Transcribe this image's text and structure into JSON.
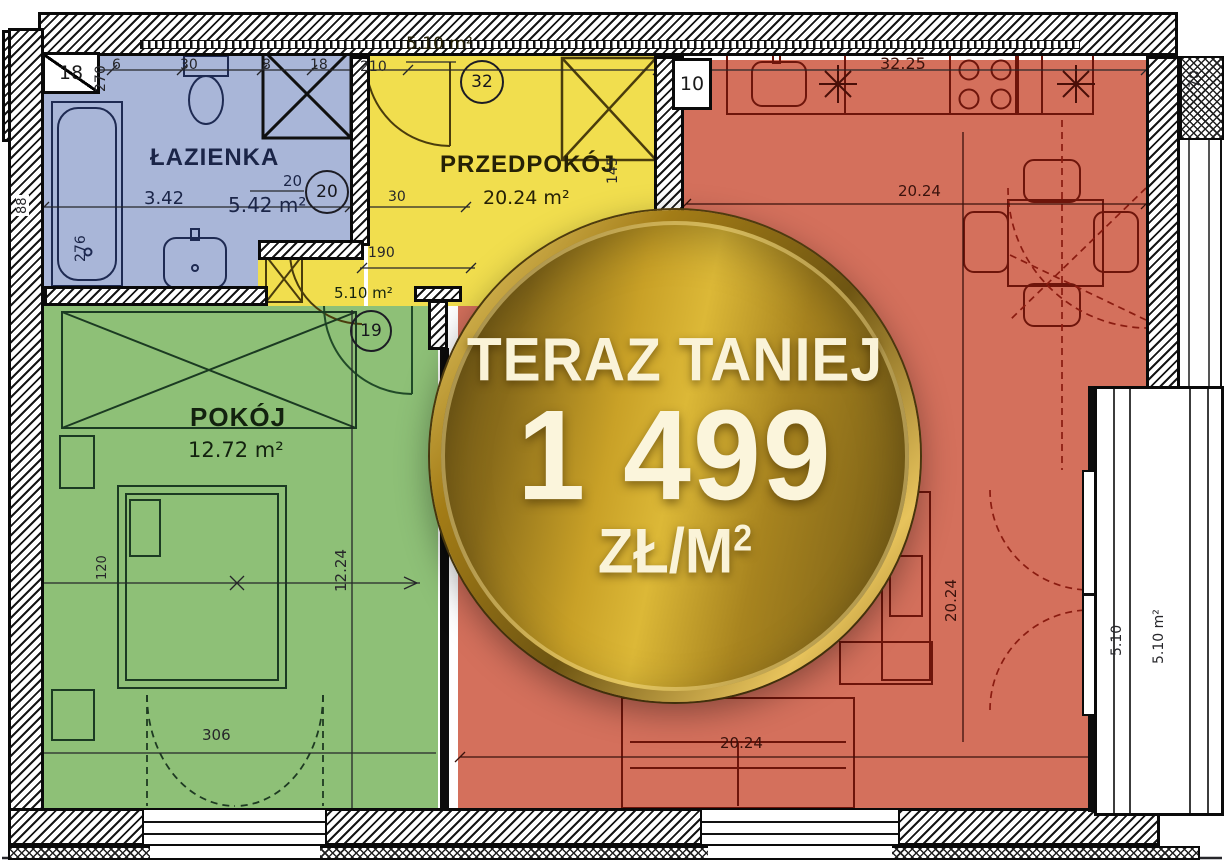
{
  "promo_badge": {
    "headline": "TERAZ TANIEJ",
    "price": "1 499",
    "unit": "ZŁ/M",
    "unit_sup": "2"
  },
  "rooms": {
    "bathroom": {
      "name": "ŁAZIENKA",
      "area": "5.42 m²",
      "secondary_dim": "3.42",
      "tag_value": "20",
      "tag_circle": "20"
    },
    "hallway": {
      "name": "PRZEDPOKÓJ",
      "area": "20.24 m²",
      "tag_circle": "32",
      "tag_area": "5.10 m²"
    },
    "bedroom": {
      "name": "POKÓJ",
      "area": "12.72 m²",
      "tag_circle": "19",
      "tag_area": "5.10 m²"
    },
    "living_kitchen": {
      "kitchen_dim": "32.25"
    },
    "balcony": {
      "width_dim": "5.10",
      "area": "5.10 m²"
    },
    "shaft_label": "10"
  },
  "dimensions": {
    "top_row": {
      "d18": "18",
      "d270": "270",
      "d6": "6",
      "d30": "30",
      "d8": "8",
      "d18b": "18",
      "d210": "210",
      "d70": "70"
    },
    "left": {
      "d88": "88",
      "tub_276": "276"
    },
    "hallway": {
      "d30": "30",
      "d190": "190",
      "d145": "145"
    },
    "bedroom": {
      "height_1224": "12.24",
      "bed_120": "120",
      "width_306": "306"
    },
    "living": {
      "top_2024": "20.24",
      "right_2024": "20.24",
      "bottom_2024": "20.24"
    }
  },
  "colors": {
    "bathroom_fill": "#a9b6d8",
    "hallway_fill": "#f1de4e",
    "bedroom_fill": "#8ec077",
    "living_fill": "#d4705c",
    "badge_gold": "#c59d24",
    "badge_text": "#faf3d8",
    "wall": "#111111"
  }
}
